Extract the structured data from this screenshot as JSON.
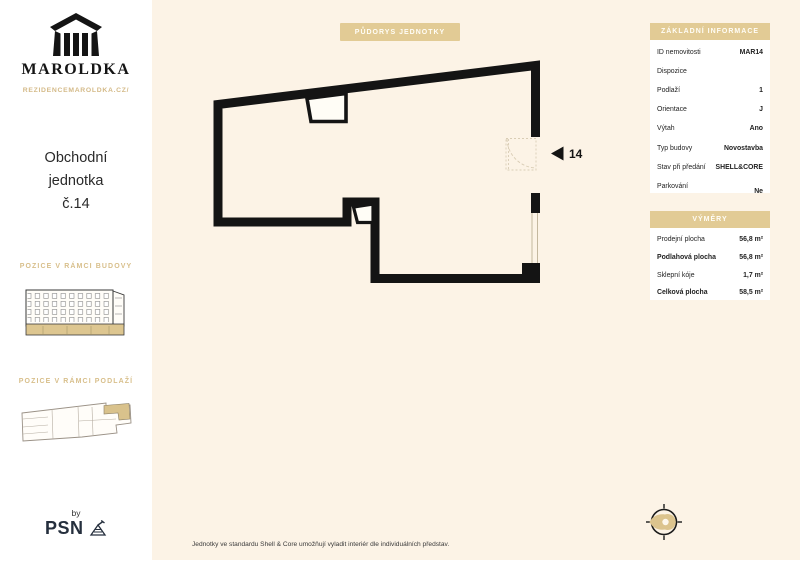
{
  "colors": {
    "accent_tan": "#e2cb95",
    "background_cream": "#fcf3e6",
    "ink": "#1a1a1a",
    "psn_navy": "#252f3d",
    "heading_gold": "#d8bf8b"
  },
  "sidebar": {
    "brand_name": "MAROLDKA",
    "brand_url": "REZIDENCEMAROLDKA.CZ/",
    "unit_title_line1": "Obchodní",
    "unit_title_line2": "jednotka",
    "unit_title_line3": "č.14",
    "section_building": "POZICE V RÁMCI BUDOVY",
    "section_floor": "POZICE V RÁMCI PODLAŽÍ",
    "by_label": "by",
    "publisher": "PSN"
  },
  "plan": {
    "title": "PŮDORYS JEDNOTKY",
    "unit_number": "14"
  },
  "info_panel": {
    "title": "ZÁKLADNÍ INFORMACE",
    "rows": [
      {
        "label": "ID nemovitosti",
        "value": "MAR14"
      },
      {
        "label": "Dispozice",
        "value": ""
      },
      {
        "label": "Podlaží",
        "value": "1"
      },
      {
        "label": "Orientace",
        "value": "J"
      },
      {
        "label": "Výtah",
        "value": "Ano"
      },
      {
        "label": "Typ budovy",
        "value": "Novostavba"
      },
      {
        "label": "Stav při předání",
        "value": "SHELL&CORE"
      },
      {
        "label": "Parkování",
        "value": "Ne"
      }
    ]
  },
  "area_panel": {
    "title": "VÝMĚRY",
    "rows": [
      {
        "label": "Prodejní plocha",
        "value": "56,8 m²"
      },
      {
        "label": "Podlahová plocha",
        "value": "56,8 m²"
      },
      {
        "label": "Sklepní kóje",
        "value": "1,7 m²"
      },
      {
        "label": "Celková plocha",
        "value": "58,5 m²"
      }
    ]
  },
  "footer": {
    "disclaimer": "Jednotky ve standardu Shell & Core umožňují vyladit interiér dle individuálních představ."
  }
}
